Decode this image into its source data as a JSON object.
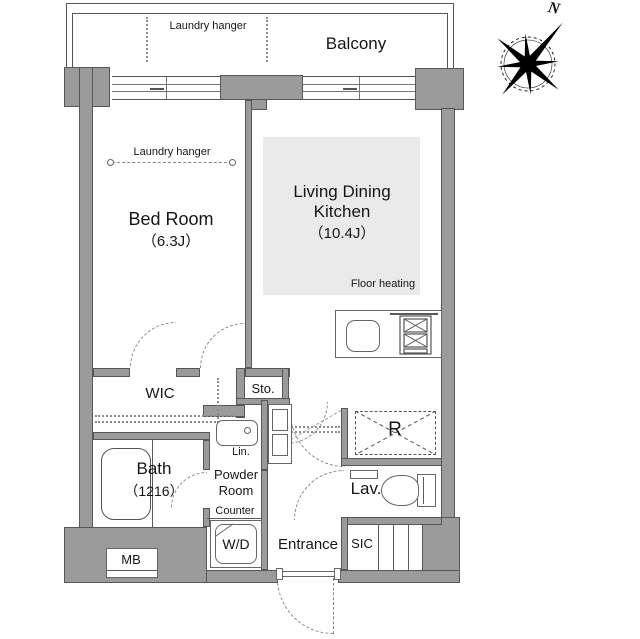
{
  "colors": {
    "wall_fill": "#9b9b9b",
    "wall_edge": "#575757",
    "line": "#555555",
    "floor_heating_fill": "#eaeaea",
    "background": "#ffffff",
    "text": "#161616"
  },
  "compass": {
    "north_label": "N"
  },
  "balcony": {
    "label": "Balcony",
    "laundry_hanger": "Laundry hanger"
  },
  "bedroom": {
    "label": "Bed Room",
    "size": "（6.3J）",
    "laundry_hanger": "Laundry hanger"
  },
  "ldk": {
    "label_line1": "Living Dining",
    "label_line2": "Kitchen",
    "size": "（10.4J）",
    "floor_heating": "Floor heating"
  },
  "storage": {
    "wic": "WIC",
    "sto": "Sto.",
    "sic": "SIC",
    "lin": "Lin.",
    "refrigerator": "R",
    "meter_box": "MB"
  },
  "bath": {
    "label": "Bath",
    "size": "（1216）"
  },
  "powder_room": {
    "label_line1": "Powder",
    "label_line2": "Room",
    "counter": "Counter",
    "washer_dryer": "W/D"
  },
  "lavatory": {
    "label": "Lav."
  },
  "entrance": {
    "label": "Entrance"
  }
}
